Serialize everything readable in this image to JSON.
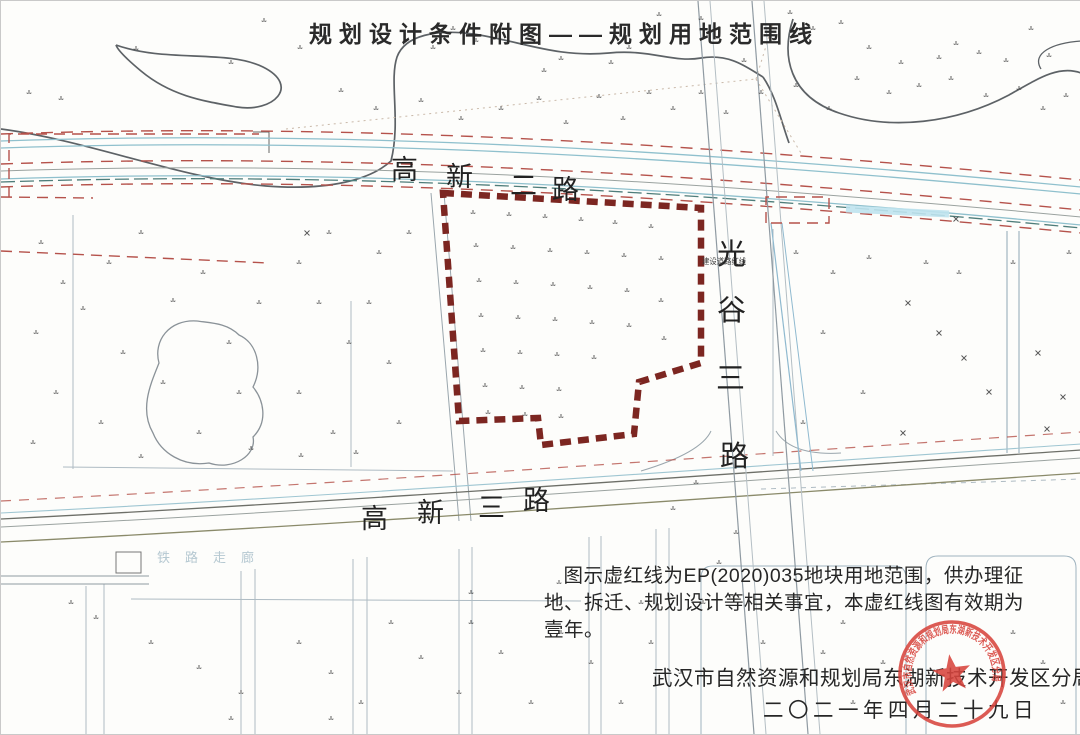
{
  "title": "规划设计条件附图——规划用地范围线",
  "roads": {
    "gaoxin_er_lu": {
      "name": "高新二路",
      "chars": [
        "高",
        "新",
        "二",
        "路"
      ]
    },
    "gaoxin_san_lu": {
      "name": "高新三路",
      "chars": [
        "高",
        "新",
        "三",
        "路"
      ]
    },
    "guanggu_san_lu": {
      "name": "光谷三路",
      "chars": [
        "光",
        "谷",
        "三",
        "路"
      ]
    }
  },
  "annotations": {
    "road_side_note": "建设道路红线",
    "rail_corridor": "铁路走廊"
  },
  "note": "图示虚红线为EP(2020)035地块用地范围，供办理征地、拆迁、规划设计等相关事宜，本虚红线图有效期为壹年。",
  "footer": {
    "agency": "武汉市自然资源和规划局东湖新技术开发区分局",
    "date": "二〇二一年四月二十九日"
  },
  "seal": {
    "text": "武汉市自然资源和规划局东湖新技术开发区分局",
    "color": "#d8453e"
  },
  "colors": {
    "boundary": "#7c2621",
    "road_red": "#b5524b",
    "road_teal": "#8fc0cd",
    "parcel": "#aebbc3"
  },
  "boundary": {
    "label": "规划用地范围线",
    "points": [
      [
        442,
        192
      ],
      [
        700,
        207
      ],
      [
        700,
        362
      ],
      [
        638,
        381
      ],
      [
        633,
        433
      ],
      [
        540,
        444
      ],
      [
        537,
        417
      ],
      [
        458,
        420
      ]
    ]
  },
  "map": {
    "veg_marks": [
      [
        263,
        20
      ],
      [
        299,
        47
      ],
      [
        320,
        35
      ],
      [
        432,
        47
      ],
      [
        452,
        28
      ],
      [
        475,
        40
      ],
      [
        543,
        70
      ],
      [
        560,
        58
      ],
      [
        610,
        62
      ],
      [
        628,
        47
      ],
      [
        658,
        14
      ],
      [
        684,
        30
      ],
      [
        700,
        18
      ],
      [
        743,
        60
      ],
      [
        789,
        12
      ],
      [
        812,
        28
      ],
      [
        840,
        22
      ],
      [
        868,
        47
      ],
      [
        900,
        62
      ],
      [
        938,
        57
      ],
      [
        955,
        43
      ],
      [
        978,
        52
      ],
      [
        1005,
        60
      ],
      [
        1030,
        28
      ],
      [
        1048,
        55
      ],
      [
        1065,
        95
      ],
      [
        135,
        48
      ],
      [
        60,
        98
      ],
      [
        28,
        92
      ],
      [
        230,
        62
      ],
      [
        340,
        90
      ],
      [
        375,
        108
      ],
      [
        420,
        100
      ],
      [
        460,
        118
      ],
      [
        500,
        108
      ],
      [
        538,
        98
      ],
      [
        565,
        122
      ],
      [
        598,
        96
      ],
      [
        622,
        118
      ],
      [
        648,
        92
      ],
      [
        672,
        108
      ],
      [
        700,
        92
      ],
      [
        725,
        112
      ],
      [
        760,
        92
      ],
      [
        795,
        85
      ],
      [
        828,
        108
      ],
      [
        856,
        78
      ],
      [
        888,
        92
      ],
      [
        918,
        85
      ],
      [
        950,
        78
      ],
      [
        985,
        95
      ],
      [
        1018,
        88
      ],
      [
        1042,
        108
      ],
      [
        40,
        242
      ],
      [
        62,
        282
      ],
      [
        35,
        332
      ],
      [
        55,
        392
      ],
      [
        32,
        442
      ],
      [
        108,
        262
      ],
      [
        140,
        232
      ],
      [
        172,
        300
      ],
      [
        202,
        272
      ],
      [
        122,
        352
      ],
      [
        100,
        422
      ],
      [
        140,
        456
      ],
      [
        198,
        432
      ],
      [
        238,
        392
      ],
      [
        228,
        342
      ],
      [
        258,
        302
      ],
      [
        298,
        262
      ],
      [
        328,
        232
      ],
      [
        318,
        302
      ],
      [
        348,
        342
      ],
      [
        298,
        392
      ],
      [
        332,
        432
      ],
      [
        368,
        302
      ],
      [
        388,
        362
      ],
      [
        398,
        422
      ],
      [
        378,
        252
      ],
      [
        408,
        232
      ],
      [
        162,
        382
      ],
      [
        82,
        308
      ],
      [
        250,
        448
      ],
      [
        300,
        455
      ],
      [
        355,
        452
      ],
      [
        472,
        212
      ],
      [
        508,
        214
      ],
      [
        544,
        216
      ],
      [
        580,
        219
      ],
      [
        614,
        222
      ],
      [
        650,
        226
      ],
      [
        475,
        245
      ],
      [
        512,
        247
      ],
      [
        549,
        250
      ],
      [
        586,
        252
      ],
      [
        623,
        255
      ],
      [
        660,
        258
      ],
      [
        478,
        280
      ],
      [
        515,
        282
      ],
      [
        552,
        284
      ],
      [
        589,
        287
      ],
      [
        626,
        290
      ],
      [
        480,
        315
      ],
      [
        517,
        317
      ],
      [
        554,
        319
      ],
      [
        591,
        322
      ],
      [
        628,
        325
      ],
      [
        482,
        350
      ],
      [
        519,
        352
      ],
      [
        556,
        354
      ],
      [
        593,
        357
      ],
      [
        484,
        385
      ],
      [
        521,
        387
      ],
      [
        558,
        389
      ],
      [
        487,
        412
      ],
      [
        524,
        414
      ],
      [
        560,
        416
      ],
      [
        660,
        300
      ],
      [
        663,
        338
      ],
      [
        795,
        252
      ],
      [
        832,
        272
      ],
      [
        868,
        257
      ],
      [
        1012,
        262
      ],
      [
        1068,
        252
      ],
      [
        822,
        332
      ],
      [
        862,
        392
      ],
      [
        802,
        422
      ],
      [
        925,
        262
      ],
      [
        958,
        272
      ],
      [
        70,
        602
      ],
      [
        95,
        617
      ],
      [
        150,
        642
      ],
      [
        198,
        667
      ],
      [
        240,
        692
      ],
      [
        298,
        642
      ],
      [
        330,
        672
      ],
      [
        360,
        702
      ],
      [
        390,
        622
      ],
      [
        420,
        657
      ],
      [
        458,
        692
      ],
      [
        470,
        622
      ],
      [
        500,
        652
      ],
      [
        530,
        702
      ],
      [
        560,
        632
      ],
      [
        590,
        662
      ],
      [
        620,
        702
      ],
      [
        650,
        642
      ],
      [
        680,
        672
      ],
      [
        470,
        592
      ],
      [
        558,
        582
      ],
      [
        640,
        602
      ],
      [
        330,
        718
      ],
      [
        230,
        718
      ],
      [
        762,
        642
      ],
      [
        790,
        682
      ],
      [
        822,
        652
      ],
      [
        852,
        702
      ],
      [
        882,
        662
      ],
      [
        842,
        622
      ],
      [
        1012,
        632
      ],
      [
        1042,
        662
      ],
      [
        1062,
        702
      ],
      [
        735,
        532
      ],
      [
        718,
        562
      ],
      [
        702,
        602
      ],
      [
        695,
        482
      ],
      [
        672,
        508
      ]
    ],
    "x_marks": [
      [
        907,
        302
      ],
      [
        938,
        332
      ],
      [
        963,
        357
      ],
      [
        988,
        391
      ],
      [
        1037,
        352
      ],
      [
        1062,
        396
      ],
      [
        902,
        432
      ],
      [
        1046,
        428
      ],
      [
        306,
        232
      ],
      [
        955,
        218
      ]
    ]
  }
}
